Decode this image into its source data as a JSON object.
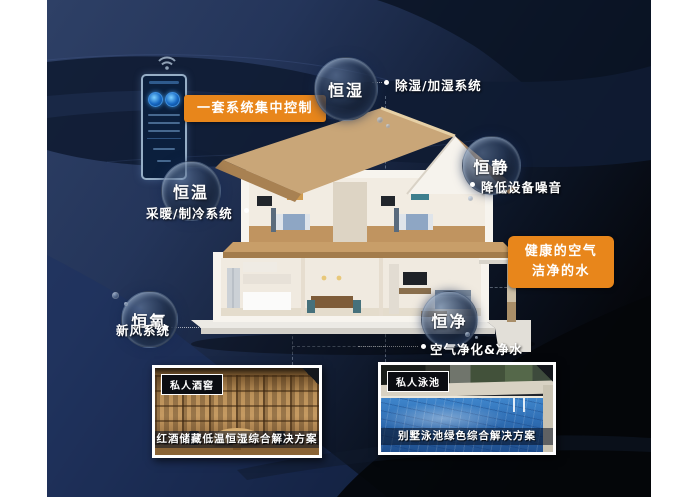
{
  "scene": {
    "control_label": "一套系统集中控制",
    "highlight_box": {
      "line1": "健康的空气",
      "line2": "洁净的水"
    }
  },
  "bubbles": {
    "humidity": {
      "label": "恒湿",
      "feature": "除湿/加湿系统"
    },
    "quiet": {
      "label": "恒静",
      "feature": "降低设备噪音"
    },
    "temperature": {
      "label": "恒温",
      "feature": "采暖/制冷系统"
    },
    "oxygen": {
      "label": "恒氧",
      "feature": "新风系统"
    },
    "purity": {
      "label": "恒净",
      "feature": "空气净化&净水"
    }
  },
  "cards": {
    "wine": {
      "tag": "私人酒窖",
      "caption": "红酒储藏低温恒湿综合解决方案"
    },
    "pool": {
      "tag": "私人泳池",
      "caption": "别墅泳池绿色综合解决方案"
    }
  },
  "colors": {
    "accent_orange": "#E8861B",
    "background_navy": "#253658",
    "background_dark": "#070B12"
  }
}
